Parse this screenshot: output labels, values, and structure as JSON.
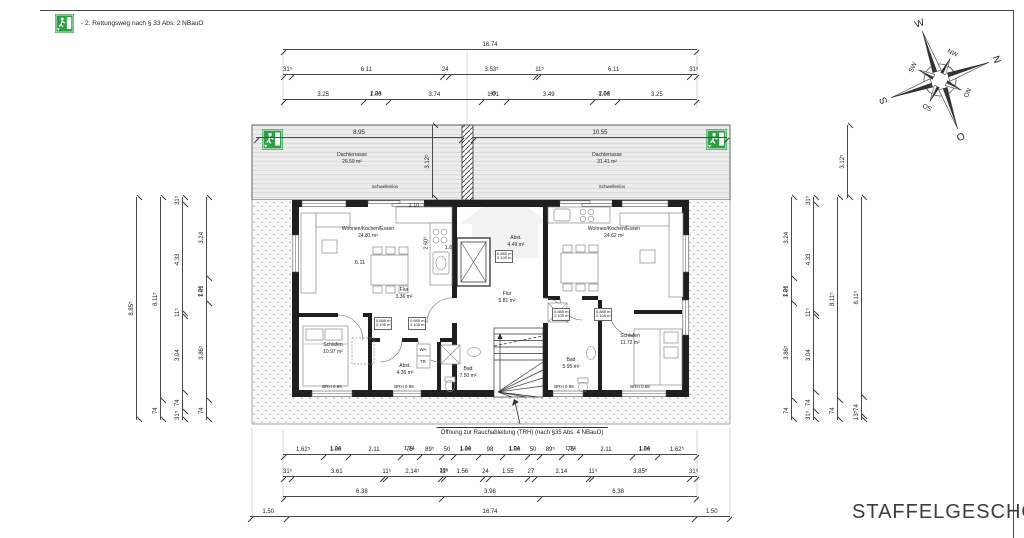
{
  "frame": {
    "title": "STAFFELGESCHOSS"
  },
  "legend": {
    "icon": "emergency-exit-icon",
    "text": "- 2. Rettungsweg nach § 33 Abs. 2 NBauO"
  },
  "compass": {
    "n": "N",
    "o": "O",
    "s": "S",
    "w": "W",
    "no": "NO",
    "so": "SO",
    "sw": "SW",
    "nw": "NW"
  },
  "plan": {
    "terrace_left": {
      "name": "Dachterrasse",
      "area": "26.59 m²"
    },
    "terrace_right": {
      "name": "Dachterrasse",
      "area": "31.41 m²"
    },
    "threshold_label": "Schwellenlos",
    "rooms": {
      "living_left": {
        "name": "Wohnen/Kochen/Essen",
        "area": "24.81 m²"
      },
      "hall_left": {
        "name": "Flur",
        "area": "3.36 m²"
      },
      "bedroom_left": {
        "name": "Schlafen",
        "area": "10.97 m²"
      },
      "storage_left": {
        "name": "Abst.",
        "area": "4.36 m²"
      },
      "bath_left": {
        "name": "Bad",
        "area": "7.50 m²"
      },
      "hall_core": {
        "name": "Flur",
        "area": "5.81 m²"
      },
      "storage_core": {
        "name": "Abst.",
        "area": "4.49 m²"
      },
      "living_right": {
        "name": "Wohnen/Kochen/Essen",
        "area": "24.62 m²"
      },
      "bath_right": {
        "name": "Bad",
        "area": "5.95 m²"
      },
      "bedroom_right": {
        "name": "Schlafen",
        "area": "11.72 m²"
      }
    },
    "door_spec": {
      "width": "0.885 m",
      "height": "2.105 m"
    },
    "appliances": {
      "washer": "WA",
      "dryer": "TR"
    },
    "sill_label": "BRH 0.88",
    "smoke_note": "Öffnung zur Rauchableitung (TRH) (nach §35 Abs. 4 NBauO)",
    "interior_dims": {
      "living_width": "6.11",
      "kitchen_top": "2.10",
      "kitchen_side": "2.60⁵",
      "shaft": "1.60"
    }
  },
  "chains": {
    "top_total": {
      "segments": [
        {
          "v": "16.74"
        }
      ]
    },
    "top_openings": {
      "segments": [
        {
          "v": "31⁵"
        },
        {
          "v": "6.11"
        },
        {
          "v": "24"
        },
        {
          "v": "3.53⁵"
        },
        {
          "v": "11⁵"
        },
        {
          "v": "6.11"
        },
        {
          "v": "31⁵"
        }
      ]
    },
    "top_detail": {
      "segments": [
        {
          "v": "3.25"
        },
        {
          "v": "1.00",
          "sub": "2.24"
        },
        {
          "v": "3.74"
        },
        {
          "v": "1.01",
          "sub": "49"
        },
        {
          "v": "3.49"
        },
        {
          "v": "1.00",
          "sub": "2.24"
        },
        {
          "v": "3.25"
        }
      ]
    },
    "terrace_left_width": {
      "segments": [
        {
          "v": "8.95"
        }
      ]
    },
    "terrace_right_width": {
      "segments": [
        {
          "v": "10.55"
        }
      ]
    },
    "terrace_depth_left": {
      "segments": [
        {
          "v": "3.12⁵"
        }
      ]
    },
    "terrace_depth_right": {
      "segments": [
        {
          "v": "3.12⁵"
        }
      ]
    },
    "bottom_windows": {
      "segments": [
        {
          "v": "1.62⁵"
        },
        {
          "v": "1.00",
          "sub": "1.24"
        },
        {
          "v": "2.11"
        },
        {
          "v": "75",
          "sub": "1.24"
        },
        {
          "v": "89⁵"
        },
        {
          "v": "50"
        },
        {
          "v": "1.00",
          "sub": "1.24"
        },
        {
          "v": "98"
        },
        {
          "v": "1.00",
          "sub": "1.24"
        },
        {
          "v": "50"
        },
        {
          "v": "89⁵"
        },
        {
          "v": "75",
          "sub": "1.24"
        },
        {
          "v": "2.11"
        },
        {
          "v": "1.00",
          "sub": "1.24"
        },
        {
          "v": "1.62⁵"
        }
      ]
    },
    "bottom_walls": {
      "segments": [
        {
          "v": "31⁵"
        },
        {
          "v": "3.61"
        },
        {
          "v": "11⁵"
        },
        {
          "v": "2.14⁵"
        },
        {
          "v": "11⁵",
          "sub": "39⁵"
        },
        {
          "v": "1.56"
        },
        {
          "v": "24"
        },
        {
          "v": "1.55"
        },
        {
          "v": "27"
        },
        {
          "v": "2.14"
        },
        {
          "v": "11⁵"
        },
        {
          "v": "3.85⁵"
        },
        {
          "v": "31⁵"
        }
      ]
    },
    "bottom_rooms": {
      "segments": [
        {
          "v": "6.38"
        },
        {
          "v": "3.98"
        },
        {
          "v": "6.38"
        }
      ]
    },
    "bottom_total": {
      "segments": [
        {
          "v": "1.50"
        },
        {
          "v": "16.74"
        },
        {
          "v": "1.50"
        }
      ]
    },
    "left_total": {
      "segments": [
        {
          "v": "8.85⁵"
        }
      ]
    },
    "left_outer": {
      "segments": [
        {
          "v": "74"
        },
        {
          "v": "8.11⁵"
        }
      ]
    },
    "left_walls": {
      "segments": [
        {
          "v": "31⁵"
        },
        {
          "v": "74"
        },
        {
          "v": "3.04"
        },
        {
          "v": "11⁵"
        },
        {
          "v": "4.33"
        },
        {
          "v": "31⁵"
        }
      ]
    },
    "left_rooms": {
      "segments": [
        {
          "v": "74"
        },
        {
          "v": "3.86⁵"
        },
        {
          "v": "1.01",
          "sub": "2.24"
        },
        {
          "v": "3.24"
        }
      ]
    },
    "right_rooms": {
      "segments": [
        {
          "v": "74"
        },
        {
          "v": "3.86⁵"
        },
        {
          "v": "1.01",
          "sub": "2.24"
        },
        {
          "v": "3.24"
        }
      ]
    },
    "right_walls": {
      "segments": [
        {
          "v": "31⁵"
        },
        {
          "v": "74"
        },
        {
          "v": "3.04"
        },
        {
          "v": "11⁵"
        },
        {
          "v": "4.33"
        },
        {
          "v": "31⁵"
        }
      ]
    },
    "right_outer": {
      "segments": [
        {
          "v": "74"
        },
        {
          "v": "8.11⁵"
        }
      ]
    },
    "right_total": {
      "segments": [
        {
          "v": "13⁵"
        },
        {
          "v": "74"
        },
        {
          "v": "8.11⁵"
        }
      ]
    }
  }
}
